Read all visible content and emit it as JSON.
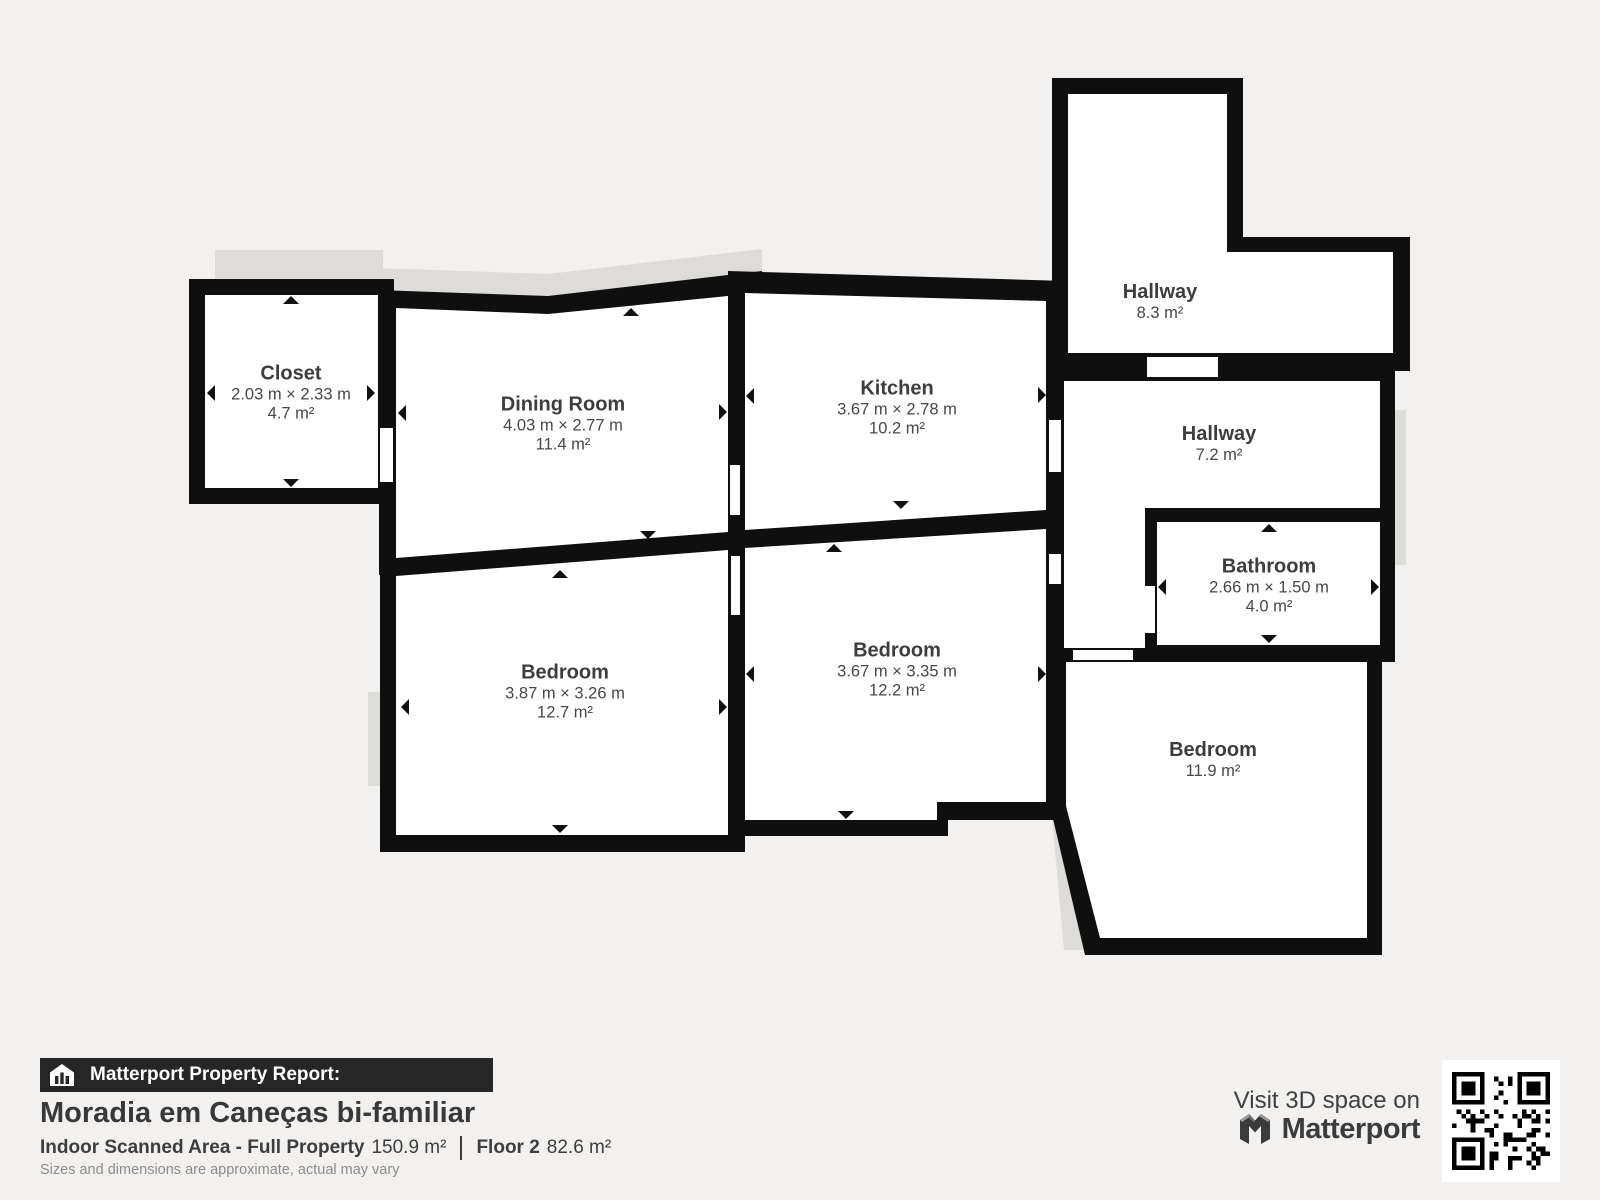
{
  "floorplan": {
    "rooms": [
      {
        "id": "closet",
        "name": "Closet",
        "dimensions": "2.03 m × 2.33 m",
        "area": "4.7 m²"
      },
      {
        "id": "dining-room",
        "name": "Dining Room",
        "dimensions": "4.03 m × 2.77 m",
        "area": "11.4 m²"
      },
      {
        "id": "kitchen",
        "name": "Kitchen",
        "dimensions": "3.67 m × 2.78 m",
        "area": "10.2 m²"
      },
      {
        "id": "hallway-upper",
        "name": "Hallway",
        "dimensions": "",
        "area": "8.3 m²"
      },
      {
        "id": "hallway-lower",
        "name": "Hallway",
        "dimensions": "",
        "area": "7.2 m²"
      },
      {
        "id": "bathroom",
        "name": "Bathroom",
        "dimensions": "2.66 m × 1.50 m",
        "area": "4.0 m²"
      },
      {
        "id": "bedroom-left",
        "name": "Bedroom",
        "dimensions": "3.87 m × 3.26 m",
        "area": "12.7 m²"
      },
      {
        "id": "bedroom-middle",
        "name": "Bedroom",
        "dimensions": "3.67 m × 3.35 m",
        "area": "12.2 m²"
      },
      {
        "id": "bedroom-right",
        "name": "Bedroom",
        "dimensions": "",
        "area": "11.9 m²"
      }
    ]
  },
  "footer": {
    "report_label": "Matterport Property Report:",
    "property_title": "Moradia em Caneças bi-familiar",
    "scanned_area_label": "Indoor Scanned Area - Full Property",
    "scanned_area_value": "150.9 m²",
    "floor_label": "Floor 2",
    "floor_value": "82.6 m²",
    "disclaimer": "Sizes and dimensions are approximate, actual may vary"
  },
  "promo": {
    "visit_text": "Visit 3D space on",
    "brand": "Matterport",
    "qr_icon": "qr-code"
  },
  "colors": {
    "background": "#f2f1ef",
    "wall": "#0f0f0f",
    "floor": "#ffffff",
    "shadow": "#dedcd9",
    "label_text": "#3d3d3d",
    "bar_background": "#262626"
  }
}
